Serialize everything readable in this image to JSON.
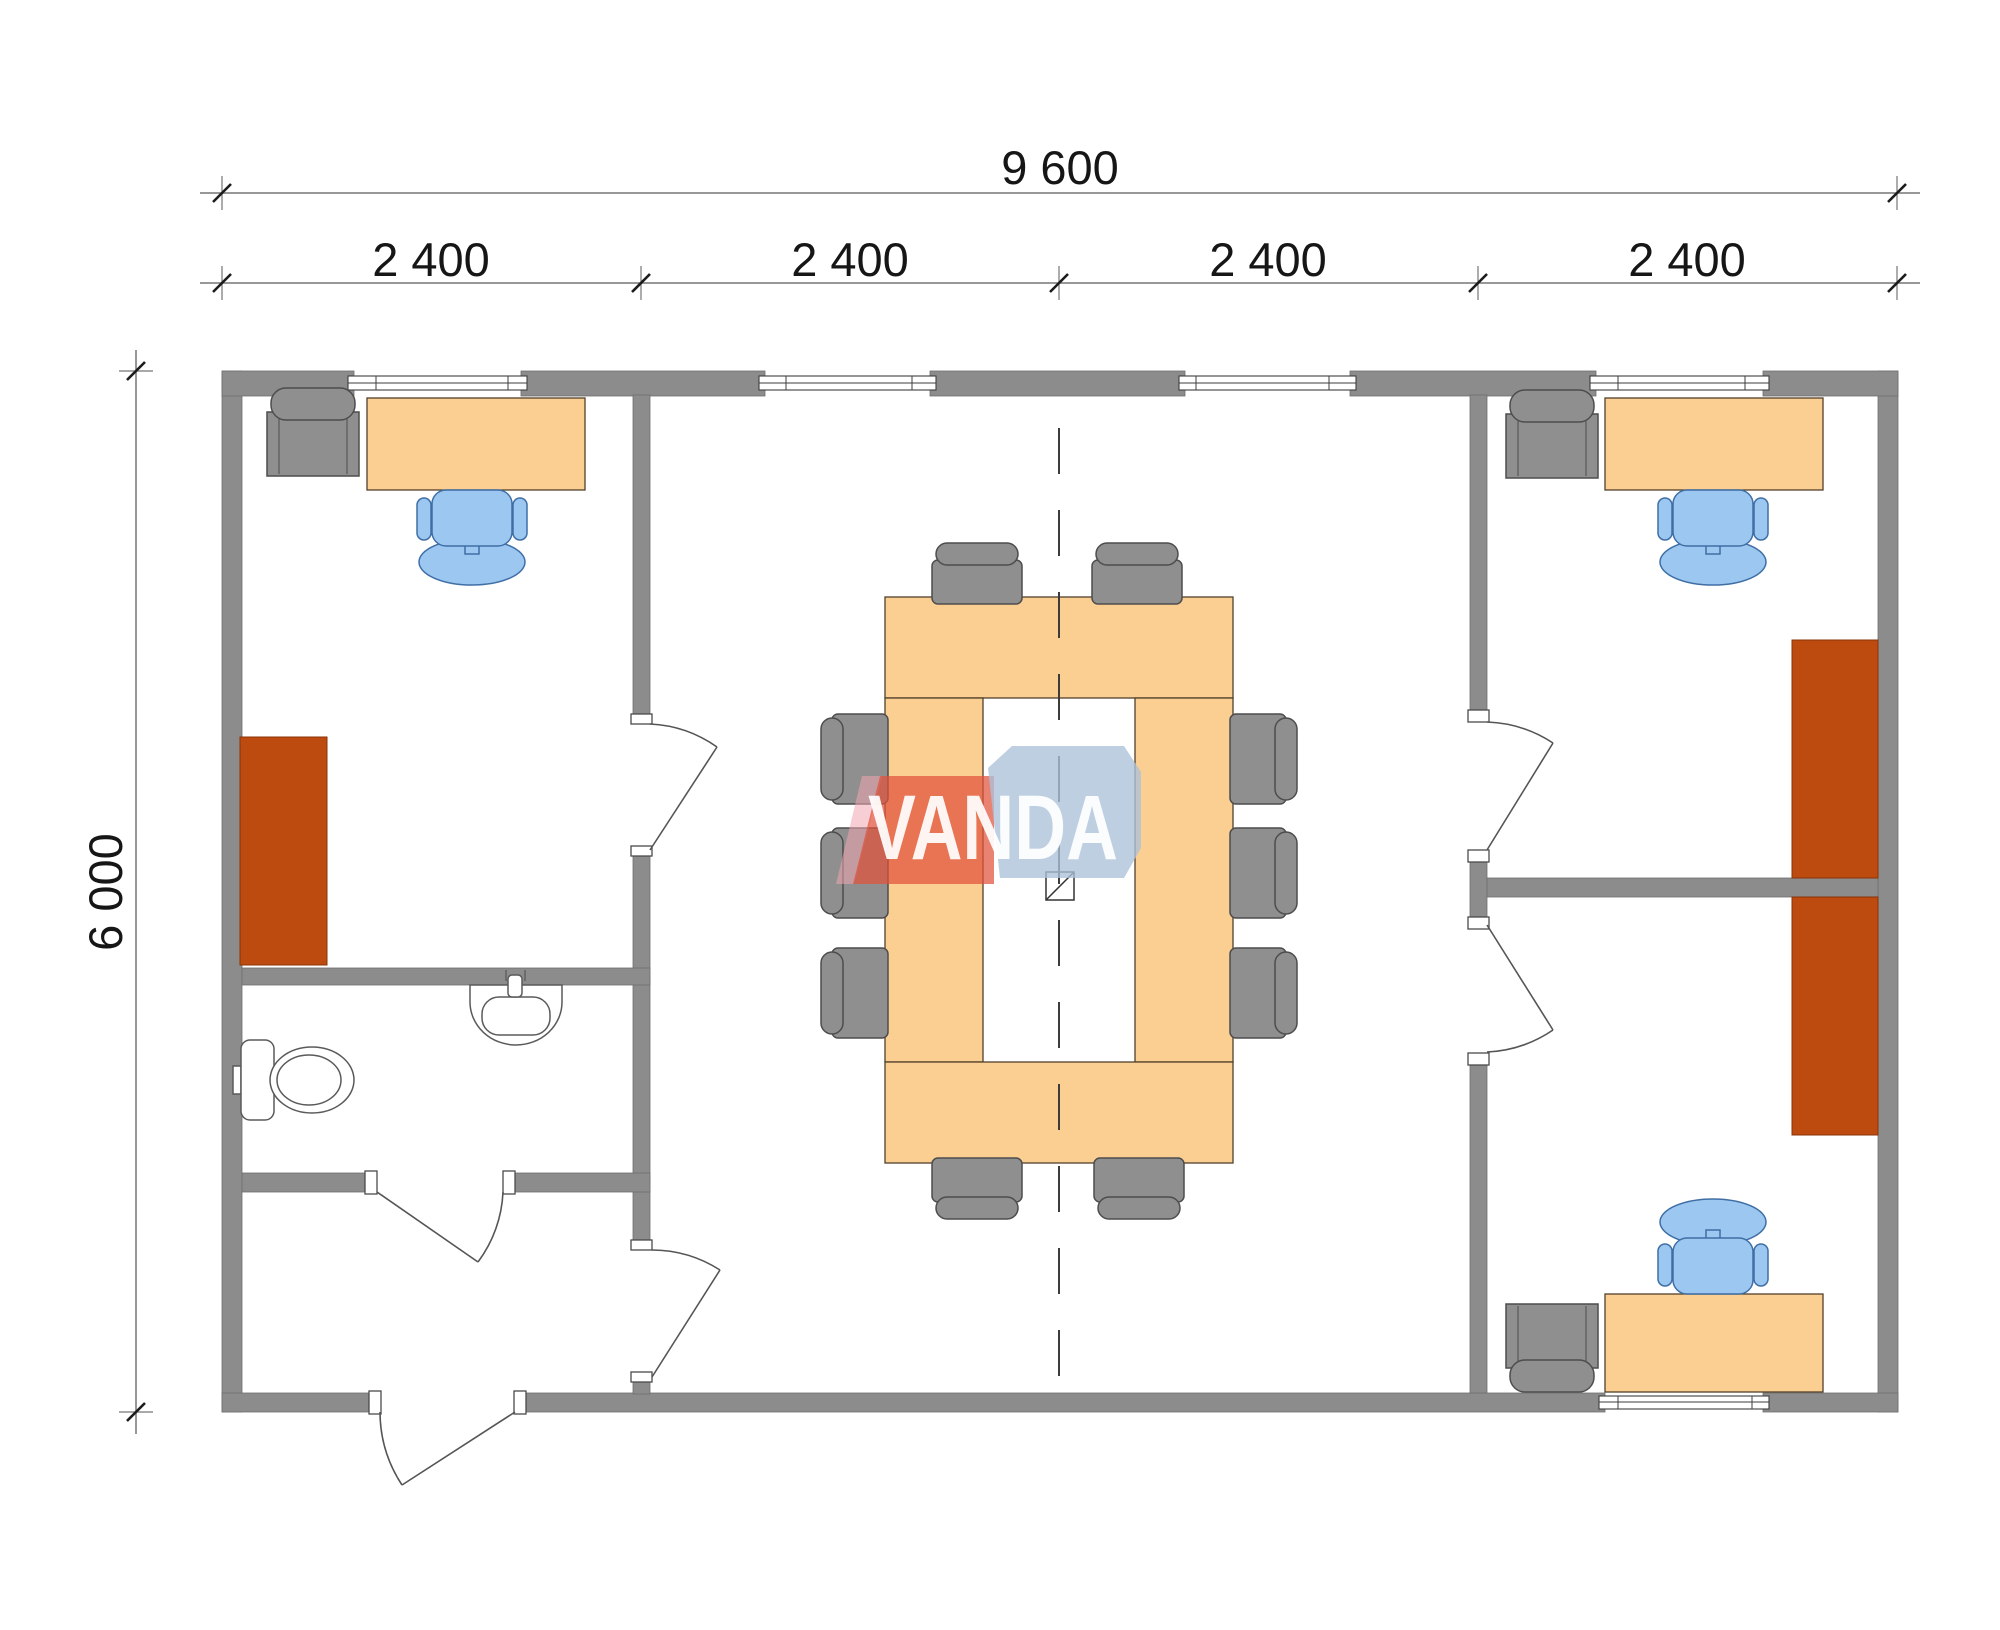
{
  "dimensions": {
    "overall_width": "9 600",
    "modules": [
      "2 400",
      "2 400",
      "2 400",
      "2 400"
    ],
    "overall_height": "6 000"
  },
  "watermark": {
    "brand": "VANDA"
  },
  "colors": {
    "wall": "#8c8c8c",
    "wood": "#fbce92",
    "cabinet": "#bd4a0e",
    "chair_gray": "#8f8f8f",
    "chair_blue": "#9bc7f1",
    "logo_red": "rgba(224,82,58,0.72)",
    "logo_blue": "rgba(172,193,218,0.78)",
    "logo_pink": "rgba(243,166,178,0.55)"
  }
}
